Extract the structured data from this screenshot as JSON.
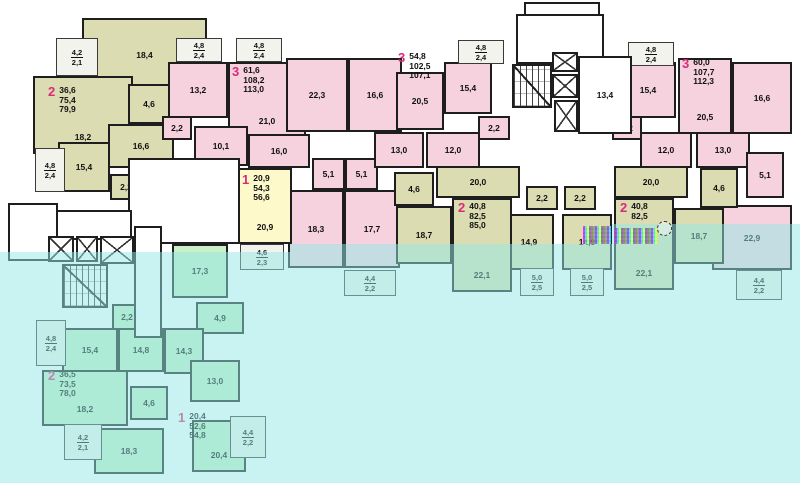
{
  "title": "apartment-building-floor-plan",
  "colors": {
    "pink": "#f5d2de",
    "olive": "#dbdcb2",
    "yellow": "#fdf9cb",
    "green": "#c9efc6",
    "background_top": "#ffffff",
    "background_bottom": "#c9f2f2",
    "wall": "#1e1e1e",
    "apartment_number_accent": "#d92b7a"
  },
  "apartments": [
    {
      "num": "2",
      "areas": [
        "36,6",
        "75,4",
        "79,9"
      ],
      "x": 48,
      "y": 86
    },
    {
      "num": "3",
      "areas": [
        "61,6",
        "108,2",
        "113,0"
      ],
      "x": 232,
      "y": 66
    },
    {
      "num": "3",
      "areas": [
        "54,8",
        "102,5",
        "107,1"
      ],
      "x": 398,
      "y": 52
    },
    {
      "num": "3",
      "areas": [
        "60,0",
        "107,7",
        "112,3"
      ],
      "x": 682,
      "y": 58
    },
    {
      "num": "1",
      "areas": [
        "20,9",
        "54,3",
        "56,6"
      ],
      "x": 242,
      "y": 174
    },
    {
      "num": "2",
      "areas": [
        "40,8",
        "82,5",
        "85,0"
      ],
      "x": 458,
      "y": 202
    },
    {
      "num": "2",
      "areas": [
        "40,8",
        "82,5"
      ],
      "x": 620,
      "y": 202
    },
    {
      "num": "2",
      "areas": [
        "36,5",
        "73,5",
        "78,0"
      ],
      "x": 48,
      "y": 370
    },
    {
      "num": "1",
      "areas": [
        "20,4",
        "52,6",
        "54,8"
      ],
      "x": 178,
      "y": 412
    }
  ],
  "rooms": [
    {
      "label": "18,4",
      "zone": "olive",
      "x": 82,
      "y": 18,
      "w": 125,
      "h": 74
    },
    {
      "label": "18,2",
      "zone": "olive",
      "x": 33,
      "y": 76,
      "w": 100,
      "h": 78,
      "lp": "b"
    },
    {
      "label": "4,6",
      "zone": "olive",
      "x": 128,
      "y": 84,
      "w": 42,
      "h": 40
    },
    {
      "label": "16,6",
      "zone": "olive",
      "x": 108,
      "y": 124,
      "w": 66,
      "h": 44
    },
    {
      "label": "15,4",
      "zone": "olive",
      "x": 58,
      "y": 142,
      "w": 52,
      "h": 50
    },
    {
      "label": "2,2",
      "zone": "olive",
      "x": 110,
      "y": 174,
      "w": 32,
      "h": 26
    },
    {
      "label": "13,2",
      "zone": "pink",
      "x": 168,
      "y": 62,
      "w": 60,
      "h": 56
    },
    {
      "label": "21,0",
      "zone": "pink",
      "x": 228,
      "y": 62,
      "w": 78,
      "h": 76,
      "lp": "b"
    },
    {
      "label": "22,3",
      "zone": "pink",
      "x": 286,
      "y": 58,
      "w": 62,
      "h": 74
    },
    {
      "label": "16,6",
      "zone": "pink",
      "x": 348,
      "y": 58,
      "w": 54,
      "h": 74
    },
    {
      "label": "2,2",
      "zone": "pink",
      "x": 162,
      "y": 116,
      "w": 30,
      "h": 24
    },
    {
      "label": "10,1",
      "zone": "pink",
      "x": 194,
      "y": 126,
      "w": 54,
      "h": 40
    },
    {
      "label": "16,0",
      "zone": "pink",
      "x": 248,
      "y": 134,
      "w": 62,
      "h": 34
    },
    {
      "label": "5,1",
      "zone": "pink",
      "x": 312,
      "y": 158,
      "w": 33,
      "h": 32
    },
    {
      "label": "5,1",
      "zone": "pink",
      "x": 345,
      "y": 158,
      "w": 33,
      "h": 32
    },
    {
      "label": "18,3",
      "zone": "pink",
      "x": 288,
      "y": 190,
      "w": 56,
      "h": 78
    },
    {
      "label": "17,7",
      "zone": "pink",
      "x": 344,
      "y": 190,
      "w": 56,
      "h": 78
    },
    {
      "label": "13,0",
      "zone": "pink",
      "x": 374,
      "y": 132,
      "w": 50,
      "h": 36
    },
    {
      "label": "20,5",
      "zone": "pink",
      "x": 396,
      "y": 72,
      "w": 48,
      "h": 58
    },
    {
      "label": "15,4",
      "zone": "pink",
      "x": 444,
      "y": 62,
      "w": 48,
      "h": 52
    },
    {
      "label": "12,0",
      "zone": "pink",
      "x": 426,
      "y": 132,
      "w": 54,
      "h": 36
    },
    {
      "label": "2,2",
      "zone": "pink",
      "x": 478,
      "y": 116,
      "w": 32,
      "h": 24
    },
    {
      "label": "15,4",
      "zone": "pink",
      "x": 620,
      "y": 62,
      "w": 56,
      "h": 56
    },
    {
      "label": "20,5",
      "zone": "pink",
      "x": 678,
      "y": 58,
      "w": 54,
      "h": 76,
      "lp": "b"
    },
    {
      "label": "16,6",
      "zone": "pink",
      "x": 732,
      "y": 62,
      "w": 60,
      "h": 72
    },
    {
      "label": "2,2",
      "zone": "pink",
      "x": 612,
      "y": 116,
      "w": 30,
      "h": 24
    },
    {
      "label": "12,0",
      "zone": "pink",
      "x": 640,
      "y": 132,
      "w": 52,
      "h": 36
    },
    {
      "label": "13,0",
      "zone": "pink",
      "x": 696,
      "y": 132,
      "w": 54,
      "h": 36
    },
    {
      "label": "5,1",
      "zone": "pink",
      "x": 746,
      "y": 152,
      "w": 38,
      "h": 46
    },
    {
      "label": "22,9",
      "zone": "pink",
      "x": 712,
      "y": 205,
      "w": 80,
      "h": 65
    },
    {
      "label": "4,6",
      "zone": "olive",
      "x": 394,
      "y": 172,
      "w": 40,
      "h": 34
    },
    {
      "label": "20,0",
      "zone": "olive",
      "x": 436,
      "y": 166,
      "w": 84,
      "h": 32
    },
    {
      "label": "2,2",
      "zone": "olive",
      "x": 526,
      "y": 186,
      "w": 32,
      "h": 24
    },
    {
      "label": "2,2",
      "zone": "olive",
      "x": 564,
      "y": 186,
      "w": 32,
      "h": 24
    },
    {
      "label": "18,7",
      "zone": "olive",
      "x": 396,
      "y": 206,
      "w": 56,
      "h": 58
    },
    {
      "label": "14,9",
      "zone": "olive",
      "x": 504,
      "y": 214,
      "w": 50,
      "h": 56
    },
    {
      "label": "22,1",
      "zone": "olive",
      "x": 452,
      "y": 198,
      "w": 60,
      "h": 94,
      "lp": "b"
    },
    {
      "label": "20,0",
      "zone": "olive",
      "x": 614,
      "y": 166,
      "w": 74,
      "h": 32
    },
    {
      "label": "4,6",
      "zone": "olive",
      "x": 700,
      "y": 168,
      "w": 38,
      "h": 40
    },
    {
      "label": "14,9",
      "zone": "olive",
      "x": 562,
      "y": 214,
      "w": 50,
      "h": 56
    },
    {
      "label": "22,1",
      "zone": "olive",
      "x": 614,
      "y": 198,
      "w": 60,
      "h": 92,
      "lp": "b"
    },
    {
      "label": "18,7",
      "zone": "olive",
      "x": 674,
      "y": 208,
      "w": 50,
      "h": 56
    },
    {
      "label": "4,7",
      "zone": "yellow",
      "x": 162,
      "y": 198,
      "w": 36,
      "h": 42
    },
    {
      "label": "11,4",
      "zone": "yellow",
      "x": 198,
      "y": 192,
      "w": 44,
      "h": 50
    },
    {
      "label": "20,9",
      "zone": "yellow",
      "x": 238,
      "y": 168,
      "w": 54,
      "h": 76,
      "lp": "b"
    },
    {
      "label": "2,2",
      "zone": "green",
      "x": 112,
      "y": 304,
      "w": 30,
      "h": 26
    },
    {
      "label": "15,4",
      "zone": "green",
      "x": 62,
      "y": 328,
      "w": 56,
      "h": 44
    },
    {
      "label": "14,8",
      "zone": "green",
      "x": 118,
      "y": 328,
      "w": 46,
      "h": 44
    },
    {
      "label": "17,3",
      "zone": "green",
      "x": 172,
      "y": 244,
      "w": 56,
      "h": 54
    },
    {
      "label": "4,9",
      "zone": "green",
      "x": 196,
      "y": 302,
      "w": 48,
      "h": 32
    },
    {
      "label": "14,3",
      "zone": "green",
      "x": 164,
      "y": 328,
      "w": 40,
      "h": 46
    },
    {
      "label": "18,2",
      "zone": "green",
      "x": 42,
      "y": 370,
      "w": 86,
      "h": 56,
      "lp": "b"
    },
    {
      "label": "4,6",
      "zone": "green",
      "x": 130,
      "y": 386,
      "w": 38,
      "h": 34
    },
    {
      "label": "13,0",
      "zone": "green",
      "x": 190,
      "y": 360,
      "w": 50,
      "h": 42
    },
    {
      "label": "18,3",
      "zone": "green",
      "x": 94,
      "y": 428,
      "w": 70,
      "h": 46
    },
    {
      "label": "20,4",
      "zone": "green",
      "x": 192,
      "y": 420,
      "w": 54,
      "h": 52,
      "lp": "b"
    }
  ],
  "balconies": [
    {
      "t": "4,2",
      "b": "2,1",
      "x": 56,
      "y": 38,
      "w": 42,
      "h": 38
    },
    {
      "t": "4,8",
      "b": "2,4",
      "x": 35,
      "y": 148,
      "w": 30,
      "h": 44
    },
    {
      "t": "4,8",
      "b": "2,4",
      "x": 176,
      "y": 38,
      "w": 46,
      "h": 24
    },
    {
      "t": "4,8",
      "b": "2,4",
      "x": 236,
      "y": 38,
      "w": 46,
      "h": 24
    },
    {
      "t": "4,8",
      "b": "2,4",
      "x": 458,
      "y": 40,
      "w": 46,
      "h": 24
    },
    {
      "t": "4,8",
      "b": "2,4",
      "x": 628,
      "y": 42,
      "w": 46,
      "h": 24
    },
    {
      "t": "5,0",
      "b": "2,5",
      "x": 520,
      "y": 268,
      "w": 34,
      "h": 28
    },
    {
      "t": "5,0",
      "b": "2,5",
      "x": 570,
      "y": 268,
      "w": 34,
      "h": 28
    },
    {
      "t": "4,4",
      "b": "2,2",
      "x": 344,
      "y": 270,
      "w": 52,
      "h": 26
    },
    {
      "t": "4,4",
      "b": "2,2",
      "x": 736,
      "y": 270,
      "w": 46,
      "h": 30
    },
    {
      "t": "4,6",
      "b": "2,3",
      "x": 240,
      "y": 244,
      "w": 44,
      "h": 26
    },
    {
      "t": "4,8",
      "b": "2,4",
      "x": 36,
      "y": 320,
      "w": 30,
      "h": 46
    },
    {
      "t": "4,2",
      "b": "2,1",
      "x": 64,
      "y": 424,
      "w": 38,
      "h": 36
    },
    {
      "t": "4,4",
      "b": "2,2",
      "x": 230,
      "y": 416,
      "w": 36,
      "h": 42
    }
  ],
  "features": [
    {
      "type": "white",
      "name": "stair-tower-cap",
      "x": 524,
      "y": 2,
      "w": 76,
      "h": 14
    },
    {
      "type": "white",
      "name": "stair-tower",
      "x": 516,
      "y": 14,
      "w": 88,
      "h": 50
    },
    {
      "type": "stairs",
      "name": "staircase-central",
      "x": 512,
      "y": 64,
      "w": 40,
      "h": 44
    },
    {
      "type": "elevator",
      "name": "elevator-shaft",
      "x": 552,
      "y": 52,
      "w": 26,
      "h": 20
    },
    {
      "type": "elevator",
      "name": "elevator-shaft",
      "x": 552,
      "y": 74,
      "w": 26,
      "h": 24
    },
    {
      "type": "elevator",
      "name": "elevator-shaft",
      "x": 554,
      "y": 100,
      "w": 24,
      "h": 32
    },
    {
      "type": "white",
      "name": "corridor-central",
      "x": 578,
      "y": 56,
      "w": 54,
      "h": 78,
      "label": "13,4"
    },
    {
      "type": "white",
      "name": "lobby",
      "x": 128,
      "y": 158,
      "w": 112,
      "h": 86
    },
    {
      "type": "white",
      "name": "entrance-hall",
      "x": 56,
      "y": 210,
      "w": 76,
      "h": 30
    },
    {
      "type": "white",
      "name": "entrance-porch",
      "x": 8,
      "y": 203,
      "w": 50,
      "h": 58
    },
    {
      "type": "elevator",
      "name": "elevator-shaft",
      "x": 48,
      "y": 236,
      "w": 26,
      "h": 26
    },
    {
      "type": "elevator",
      "name": "elevator-shaft",
      "x": 76,
      "y": 236,
      "w": 22,
      "h": 26
    },
    {
      "type": "elevator",
      "name": "elevator-shaft",
      "x": 100,
      "y": 236,
      "w": 34,
      "h": 28
    },
    {
      "type": "stairs",
      "name": "staircase-left",
      "x": 62,
      "y": 264,
      "w": 46,
      "h": 44
    },
    {
      "type": "white",
      "name": "corridor-left",
      "x": 134,
      "y": 226,
      "w": 28,
      "h": 112
    }
  ],
  "overlays": [
    {
      "x": 0,
      "y": 252,
      "w": 290,
      "h": 231
    },
    {
      "x": 290,
      "y": 244,
      "w": 322,
      "h": 239
    },
    {
      "x": 612,
      "y": 224,
      "w": 188,
      "h": 259
    }
  ],
  "artifacts": [
    {
      "x": 583,
      "y": 226,
      "w": 28,
      "h": 18
    },
    {
      "x": 615,
      "y": 228,
      "w": 42,
      "h": 16
    }
  ],
  "cursor": {
    "x": 657,
    "y": 221,
    "w": 13,
    "h": 13
  }
}
